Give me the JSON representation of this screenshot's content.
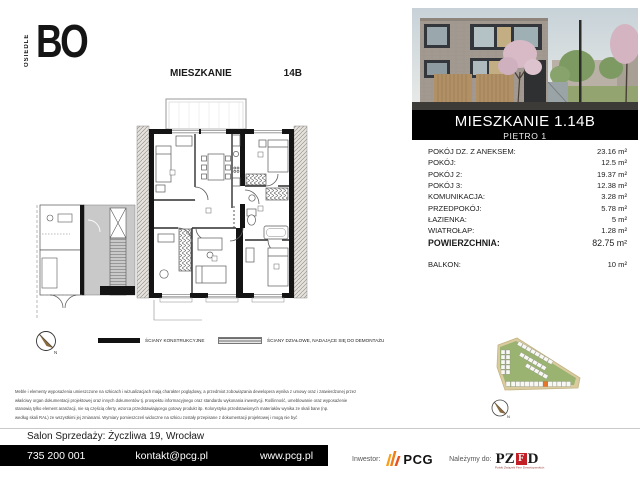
{
  "brand": {
    "logo_main": "BO",
    "logo_vertical": "OSIEDLE"
  },
  "plan_title": {
    "label": "MIESZKANIE",
    "unit": "14B"
  },
  "legend": {
    "structural": "ŚCIANY KONSTRUKCYJNE",
    "partition": "ŚCIANY DZIAŁOWE, NADAJĄCE SIĘ DO DEMONTAŻU"
  },
  "compass": {
    "north": "N"
  },
  "disclaimer": {
    "line1": "Meble i elementy wyposażenia umieszczone na szkicach i wizualizacjach mają charakter poglądowy, a przedmiot zobowiązania dewelopera wynika z umowy oraz i zatwierdzonej przez",
    "line2": "właściwy organ dokumentacji projektowej oraz innych dokumentów tj. prospektu informacyjnego oraz standardu wykonania inwestycji. Roślinność, umeblowanie oraz wyposażenie",
    "line3": "stanowią tylko element aranżacji, nie są częścią oferty, wzorca przedstawiającego gotowy produkt itp. Kolorystyka przedstawionych materiałów wynika ze skali barw (np.",
    "line4": "według skali RAL) ze wszystkimi jej zmianami. Wymiary pomieszczeń widoczne na szkicu zostały przepisane z dokumentacji projektowej i mogą nie być"
  },
  "unit_panel": {
    "title": "MIESZKANIE 1.14B",
    "floor": "PIĘTRO 1",
    "rooms": [
      {
        "label": "POKÓJ DZ. Z ANEKSEM:",
        "value": "23.16 m²"
      },
      {
        "label": "POKÓJ:",
        "value": "12.5 m²"
      },
      {
        "label": "POKÓJ 2:",
        "value": "19.37 m²"
      },
      {
        "label": "POKÓJ 3:",
        "value": "12.38 m²"
      },
      {
        "label": "KOMUNIKACJA:",
        "value": "3.28 m²"
      },
      {
        "label": "PRZEDPOKÓJ:",
        "value": "5.78 m²"
      },
      {
        "label": "ŁAZIENKA:",
        "value": "5 m²"
      },
      {
        "label": "WIATROŁAP:",
        "value": "1.28 m²"
      }
    ],
    "total": {
      "label": "POWIERZCHNIA:",
      "value": "82.75 m²"
    },
    "balcony": {
      "label": "BALKON:",
      "value": "10 m²"
    }
  },
  "footer": {
    "address": "Salon Sprzedaży: Życzliwa 19, Wrocław",
    "phone": "735 200 001",
    "email": "kontakt@pcg.pl",
    "website": "www.pcg.pl",
    "investor_label": "Inwestor:",
    "investor_name": "PCG",
    "member_label": "Należymy do:",
    "member_pz": "PZ",
    "member_f": "F",
    "member_d": "D",
    "member_sub": "Polski Związek Firm Deweloperskich"
  },
  "colors": {
    "accent_orange": "#ef7d1a",
    "brand_red": "#c22026",
    "site_highlight": "#e8762a"
  }
}
